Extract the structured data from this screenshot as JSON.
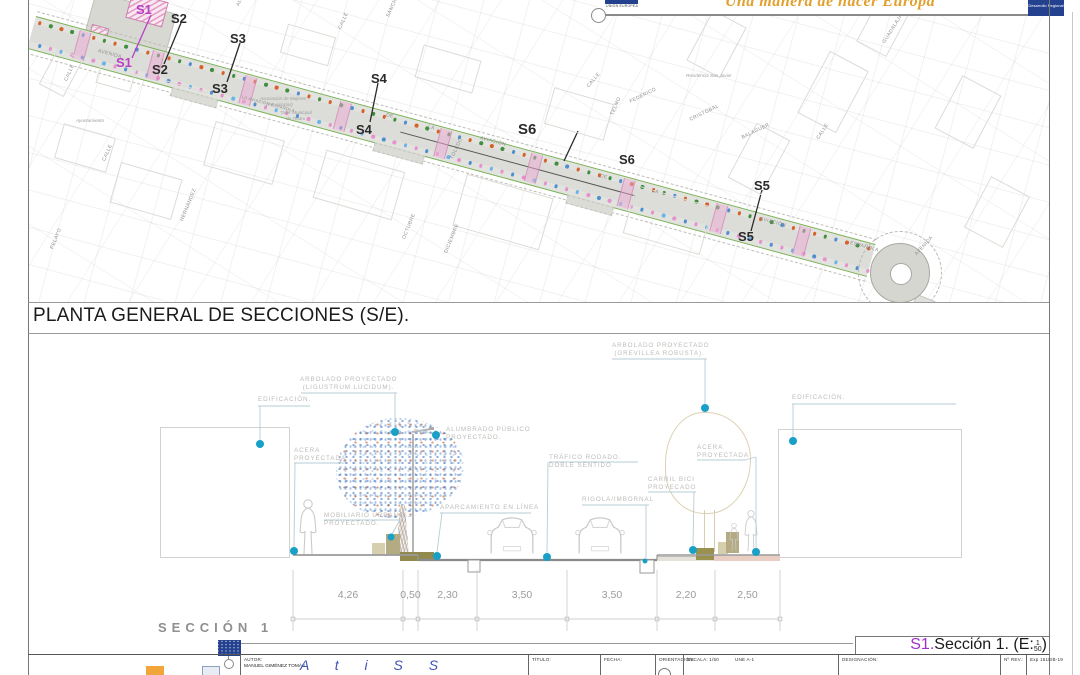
{
  "banner": {
    "eu_logo": "UNIÓN EUROPEA",
    "slogan": "Una manera de hacer Europa",
    "right_logo": [
      "Desarrollo",
      "Regional"
    ]
  },
  "plan": {
    "title": "PLANTA GENERAL DE SECCIONES (S/E).",
    "section_markers": [
      {
        "id": "S1",
        "color": "#b83fc6",
        "labels": [
          [
            136,
            2
          ],
          [
            116,
            55
          ]
        ],
        "line": [
          151,
          15,
          132,
          58
        ]
      },
      {
        "id": "S2",
        "color": "#2a2a2a",
        "labels": [
          [
            171,
            11
          ],
          [
            152,
            62
          ]
        ],
        "line": [
          181,
          23,
          164,
          64
        ]
      },
      {
        "id": "S3",
        "color": "#2a2a2a",
        "labels": [
          [
            230,
            31
          ],
          [
            212,
            81
          ]
        ],
        "line": [
          240,
          43,
          227,
          82
        ]
      },
      {
        "id": "S4",
        "color": "#2a2a2a",
        "labels": [
          [
            371,
            71
          ],
          [
            356,
            122
          ]
        ],
        "line": [
          378,
          83,
          370,
          122
        ]
      },
      {
        "id": "S6",
        "color": "#2a2a2a",
        "labels": [
          [
            518,
            121,
            15
          ],
          [
            619,
            152
          ]
        ],
        "line": [
          578,
          131,
          564,
          161
        ]
      },
      {
        "id": "S5",
        "color": "#2a2a2a",
        "labels": [
          [
            754,
            178
          ],
          [
            738,
            229
          ]
        ],
        "line": [
          762,
          190,
          751,
          231
        ]
      }
    ],
    "street_labels": [
      {
        "t": "AVENIDA",
        "x": 98,
        "y": 48,
        "r": 15
      },
      {
        "t": "LA AVIACIÓN ESPAÑOLA",
        "x": 242,
        "y": 94,
        "r": 15,
        "s": 4
      },
      {
        "t": "DE",
        "x": 386,
        "y": 112,
        "r": 15
      },
      {
        "t": "LA",
        "x": 428,
        "y": 124,
        "r": 15
      },
      {
        "t": "AVIACIÓN",
        "x": 480,
        "y": 135,
        "r": 15
      },
      {
        "t": "DE",
        "x": 600,
        "y": 173,
        "r": 15
      },
      {
        "t": "LA",
        "x": 652,
        "y": 188,
        "r": 15
      },
      {
        "t": "AVIACIÓN",
        "x": 760,
        "y": 216,
        "r": 15
      },
      {
        "t": "ESPAÑOLA",
        "x": 850,
        "y": 240,
        "r": 15
      },
      {
        "t": "AVENIDA",
        "x": 916,
        "y": 252,
        "r": -48
      },
      {
        "t": "CALLE",
        "x": 66,
        "y": 78,
        "r": -66
      },
      {
        "t": "CALLE",
        "x": 104,
        "y": 158,
        "r": -66
      },
      {
        "t": "HERNÁNDEZ",
        "x": 182,
        "y": 218,
        "r": -68
      },
      {
        "t": "PELAYO",
        "x": 52,
        "y": 246,
        "r": -68
      },
      {
        "t": "ALTEZA",
        "x": 238,
        "y": 3,
        "r": -66
      },
      {
        "t": "CALLE",
        "x": 340,
        "y": 26,
        "r": -66
      },
      {
        "t": "SÁNCHEZ",
        "x": 388,
        "y": 14,
        "r": -66
      },
      {
        "t": "OCTUBRE",
        "x": 404,
        "y": 236,
        "r": -68
      },
      {
        "t": "DICIEMBRE",
        "x": 446,
        "y": 250,
        "r": -68
      },
      {
        "t": "TOLEDO",
        "x": 452,
        "y": 156,
        "r": -66
      },
      {
        "t": "TELMO",
        "x": 612,
        "y": 112,
        "r": -66
      },
      {
        "t": "CALLE",
        "x": 588,
        "y": 84,
        "r": -50
      },
      {
        "t": "FEDERICO",
        "x": 630,
        "y": 99,
        "r": -26
      },
      {
        "t": "CRISTÓBAL",
        "x": 690,
        "y": 117,
        "r": -26
      },
      {
        "t": "BALAGUER",
        "x": 742,
        "y": 135,
        "r": -26
      },
      {
        "t": "GUADALAJARA",
        "x": 884,
        "y": 40,
        "r": -58
      },
      {
        "t": "CALLE",
        "x": 818,
        "y": 136,
        "r": -58
      }
    ],
    "place_labels": [
      {
        "t": "Ayuntamiento",
        "x": 76,
        "y": 118
      },
      {
        "t": "Asociación de Mujeres",
        "x": 260,
        "y": 96
      },
      {
        "t": "(Por Asociar)",
        "x": 266,
        "y": 102
      },
      {
        "t": "Taller Municipal",
        "x": 280,
        "y": 110
      },
      {
        "t": "de Teatro",
        "x": 286,
        "y": 116
      },
      {
        "t": "Residencia San Javier",
        "x": 686,
        "y": 73
      }
    ]
  },
  "section": {
    "name": "SECCIÓN 1",
    "callouts": [
      {
        "lines": [
          "EDIFICACIÓN."
        ],
        "x": 258,
        "y": 396,
        "segs": [
          [
            258,
            406,
            310,
            406
          ],
          [
            260,
            406,
            260,
            441
          ]
        ],
        "dot": [
          260,
          444
        ]
      },
      {
        "lines": [
          "ARBOLADO PROYECTADO",
          "(LIGUSTRUM LUCIDUM)."
        ],
        "x": 300,
        "y": 376,
        "w": 97,
        "center": true,
        "segs": [
          [
            301,
            393,
            397,
            393
          ],
          [
            395,
            393,
            395,
            429
          ]
        ],
        "dot": [
          395,
          432
        ]
      },
      {
        "lines": [
          "ALUMBRADO PÚBLICO",
          "PROYECTADO."
        ],
        "x": 446,
        "y": 426,
        "segs": [
          [
            414,
            429,
            433,
            434
          ]
        ],
        "dot": [
          436,
          435
        ]
      },
      {
        "lines": [
          "ACERA",
          "PROYECTADA"
        ],
        "x": 294,
        "y": 447,
        "segs": [
          [
            294,
            463,
            344,
            463
          ],
          [
            295,
            463,
            294,
            548
          ]
        ],
        "dot": [
          294,
          551
        ]
      },
      {
        "lines": [
          "MOBILIARIO URBANO",
          "PROYECTADO."
        ],
        "x": 324,
        "y": 512,
        "segs": [
          [
            324,
            520,
            402,
            520
          ],
          [
            400,
            520,
            392,
            534
          ]
        ],
        "dot": [
          391,
          537
        ],
        "r": 3.5
      },
      {
        "lines": [
          "APARCAMIENTO EN LÍNEA"
        ],
        "x": 440,
        "y": 504,
        "segs": [
          [
            440,
            513,
            531,
            513
          ],
          [
            442,
            513,
            437,
            552
          ]
        ],
        "dot": [
          437,
          556
        ]
      },
      {
        "lines": [
          "TRÁFICO RODADO.",
          "DOBLE SENTIDO"
        ],
        "x": 549,
        "y": 454,
        "segs": [
          [
            549,
            462,
            638,
            462
          ],
          [
            548,
            462,
            547,
            553
          ]
        ],
        "dot": [
          547,
          557
        ]
      },
      {
        "lines": [
          "RIGOLA/IMBORNAL"
        ],
        "x": 582,
        "y": 496,
        "segs": [
          [
            582,
            505,
            649,
            505
          ],
          [
            646,
            505,
            646,
            558
          ]
        ],
        "dot": [
          645,
          561
        ],
        "r": 2.5
      },
      {
        "lines": [
          "CARRIL BICI",
          "PROYECADO"
        ],
        "x": 648,
        "y": 476,
        "segs": [
          [
            648,
            492,
            696,
            492
          ],
          [
            694,
            492,
            693,
            547
          ]
        ],
        "dot": [
          693,
          550
        ]
      },
      {
        "lines": [
          "ACERA",
          "PROYECTADA"
        ],
        "x": 697,
        "y": 444,
        "segs": [
          [
            697,
            460,
            745,
            460
          ],
          [
            745,
            460,
            756,
            457
          ],
          [
            756,
            457,
            756,
            549
          ]
        ],
        "dot": [
          756,
          552
        ]
      },
      {
        "lines": [
          "ARBOLADO PROYECTADO",
          "(GREVILLEA ROBUSTA)."
        ],
        "x": 612,
        "y": 342,
        "w": 95,
        "center": true,
        "segs": [
          [
            612,
            359,
            707,
            359
          ],
          [
            705,
            359,
            705,
            405
          ]
        ],
        "dot": [
          705,
          408
        ]
      },
      {
        "lines": [
          "EDIFICACIÓN."
        ],
        "x": 792,
        "y": 394,
        "segs": [
          [
            792,
            404,
            956,
            404
          ],
          [
            793,
            404,
            793,
            438
          ]
        ],
        "dot": [
          793,
          441
        ]
      }
    ],
    "dimensions": {
      "values": [
        "4,26",
        "0,50",
        "2,30",
        "3,50",
        "3,50",
        "2,20",
        "2,50"
      ],
      "boundaries": [
        293,
        403,
        418,
        477,
        567,
        657,
        715,
        780
      ]
    },
    "ref": {
      "prefix": "S1.",
      "text": "Sección 1. (E:",
      "frac_top": "1",
      "frac_bottom": "50",
      "suffix": ")"
    }
  },
  "titleblock": {
    "author_signature": "A t i S S",
    "cells": [
      {
        "x": 240,
        "label": "AUTOR:",
        "value": "MANUEL GIMÉNEZ TOMÁS"
      },
      {
        "x": 528,
        "label": "TÍTULO:",
        "value": ""
      },
      {
        "x": 600,
        "label": "FECHA:",
        "value": ""
      },
      {
        "x": 655,
        "label": "ORIENTACIÓN:",
        "value": ""
      },
      {
        "x": 683,
        "label": "ESCALA: 1/50",
        "value": "",
        "extra": "UNE A-1"
      },
      {
        "x": 838,
        "label": "DESIGNACIÓN:",
        "value": ""
      },
      {
        "x": 1000,
        "label": "Nº REV.:",
        "value": ""
      },
      {
        "x": 1026,
        "label": "Exp 1518/B-19",
        "value": ""
      }
    ]
  },
  "colors": {
    "accent_teal": "#18a0c6",
    "marker_magenta": "#b83fc6",
    "slogan_orange": "#e2a02c",
    "eu_blue": "#24418f"
  }
}
